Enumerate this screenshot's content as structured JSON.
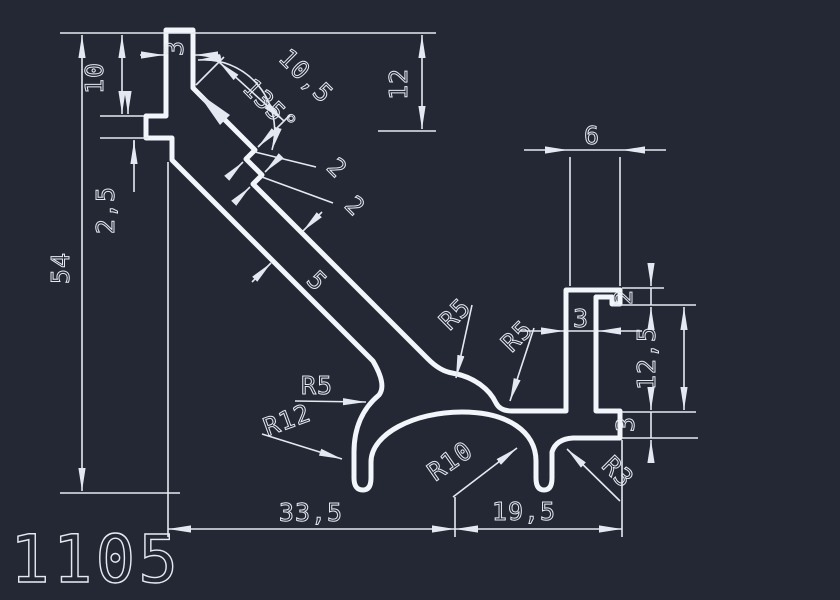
{
  "drawing": {
    "profile_number": "1105",
    "colors": {
      "background": "#232834",
      "profile_line": "#f2f5f9",
      "dimension": "#e4e9f1"
    },
    "dims": {
      "bar_width": "3",
      "top_offset": "10",
      "notch_height": "2,5",
      "overall_height": "54",
      "angle": "135°",
      "diagonal_length": "10,5",
      "top_height": "12",
      "step_first": "2",
      "step_second": "2",
      "wall_thickness": "5",
      "fillet_r5_arm": "R5",
      "fillet_r5_web": "R5",
      "fillet_r5_left": "R5",
      "fillet_r12": "R12",
      "fillet_r10": "R10",
      "fillet_r3": "R3",
      "channel_width": "6",
      "lip_height": "2",
      "channel_wall": "3",
      "channel_height": "12,5",
      "base_height": "3",
      "width_left": "33,5",
      "width_right": "19,5"
    }
  }
}
